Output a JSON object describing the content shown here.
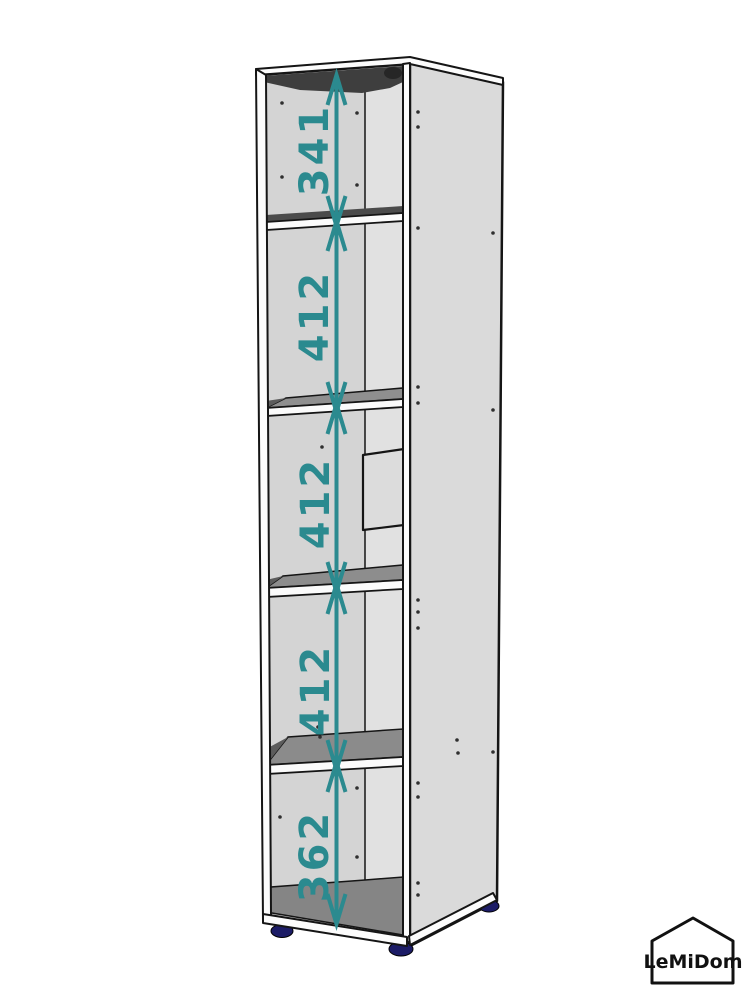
{
  "page": {
    "background": "#ffffff",
    "description": "Assembly-style dimension diagram of a tall single-column shelving unit with five open compartments"
  },
  "diagram": {
    "type": "furniture-dimension-diagram",
    "accent_color": "#2b8a8f",
    "feet_color": "#1c1c66",
    "outline_color": "#151515",
    "panel_color": "#dadada",
    "shelf_top_color": "#8d8d8d",
    "shadow_color": "#3e3e3e",
    "sections": [
      {
        "id": 1,
        "label": "341",
        "value": 341
      },
      {
        "id": 2,
        "label": "412",
        "value": 412
      },
      {
        "id": 3,
        "label": "412",
        "value": 412
      },
      {
        "id": 4,
        "label": "412",
        "value": 412
      },
      {
        "id": 5,
        "label": "362",
        "value": 362
      }
    ]
  },
  "logo": {
    "text": "LeMiDom"
  }
}
